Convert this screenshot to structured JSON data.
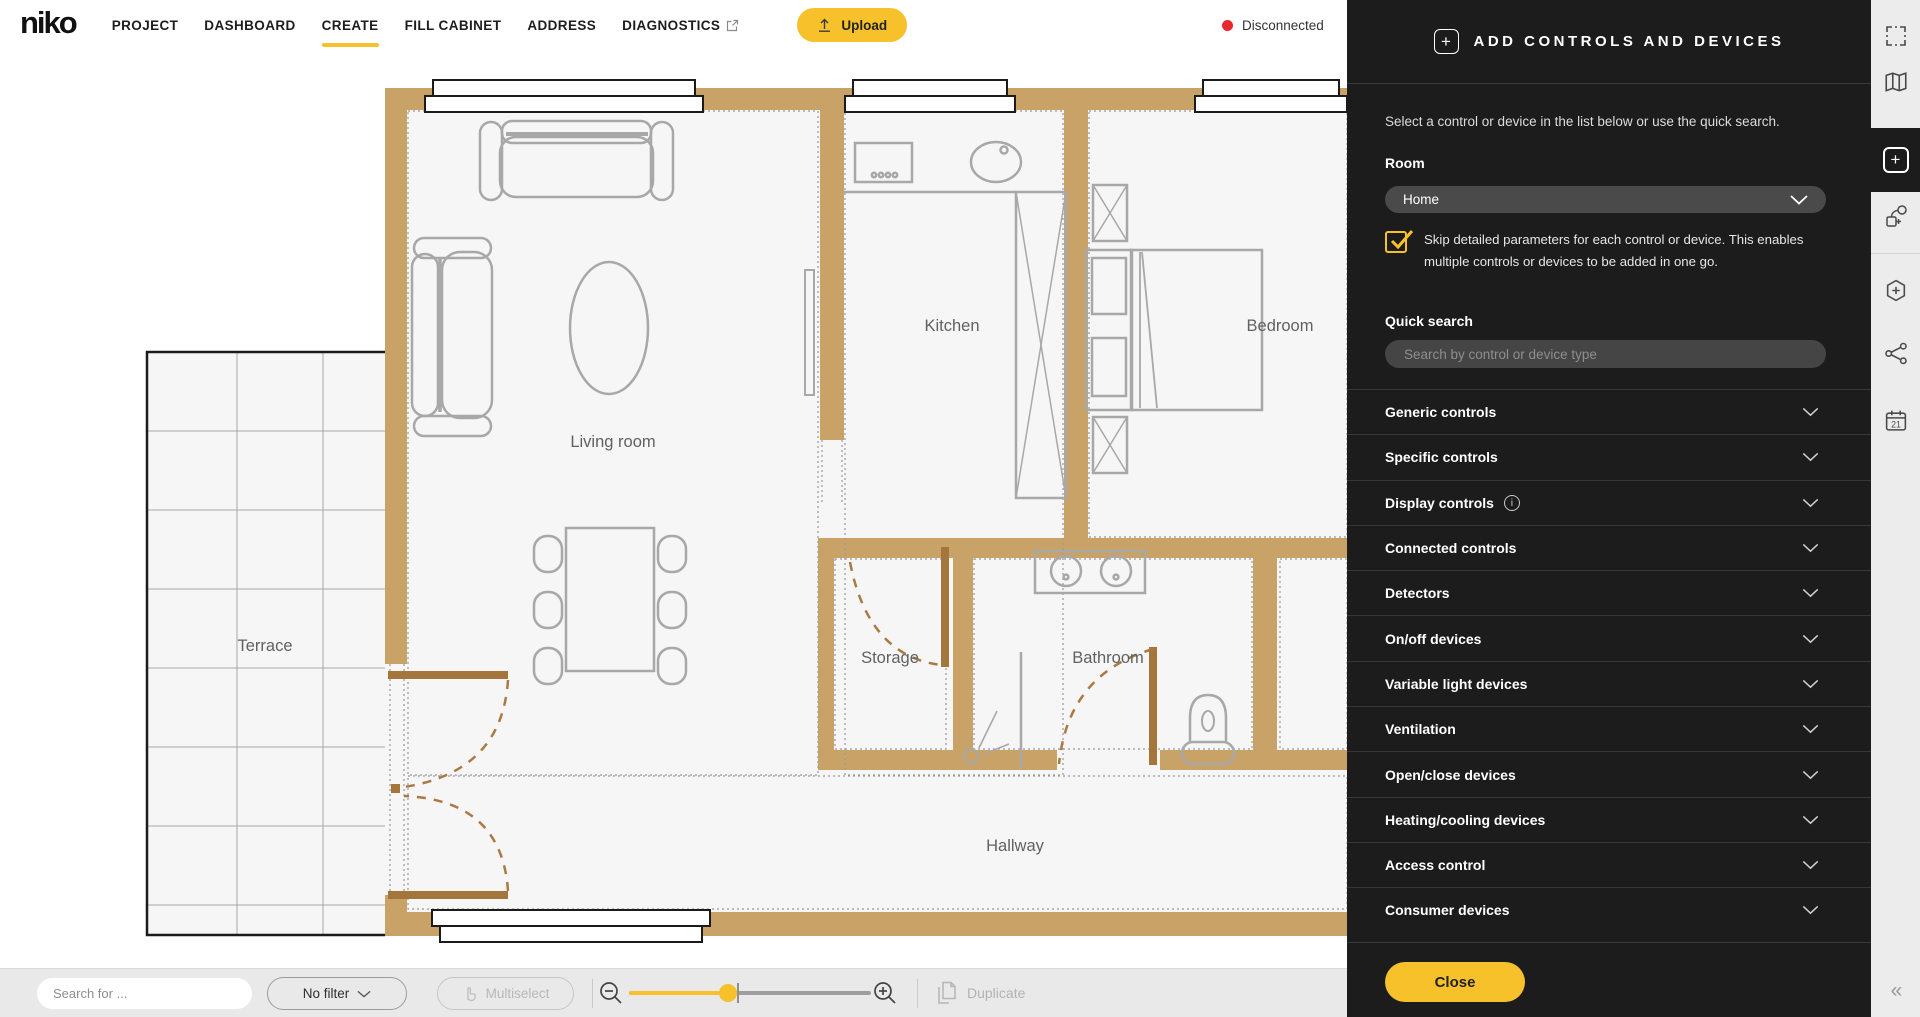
{
  "header": {
    "logo": "niko",
    "nav": [
      {
        "label": "PROJECT"
      },
      {
        "label": "DASHBOARD"
      },
      {
        "label": "CREATE"
      },
      {
        "label": "FILL CABINET"
      },
      {
        "label": "ADDRESS"
      },
      {
        "label": "DIAGNOSTICS",
        "external": true
      }
    ],
    "active": "CREATE",
    "upload": "Upload",
    "status": "Disconnected"
  },
  "panel": {
    "title": "ADD CONTROLS AND DEVICES",
    "intro": "Select a control or device in the list below or use the quick search.",
    "room_label": "Room",
    "room_value": "Home",
    "skip_text": "Skip detailed parameters for each control or device. This enables multiple controls or devices to be added in one go.",
    "quick_search_label": "Quick search",
    "search_placeholder": "Search by control or device type",
    "categories": [
      {
        "label": "Generic controls",
        "info": false
      },
      {
        "label": "Specific controls",
        "info": false
      },
      {
        "label": "Display controls",
        "info": true
      },
      {
        "label": "Connected controls",
        "info": false
      },
      {
        "label": "Detectors",
        "info": false
      },
      {
        "label": "On/off devices",
        "info": false
      },
      {
        "label": "Variable light devices",
        "info": false
      },
      {
        "label": "Ventilation",
        "info": false
      },
      {
        "label": "Open/close devices",
        "info": false
      },
      {
        "label": "Heating/cooling devices",
        "info": false
      },
      {
        "label": "Access control",
        "info": false
      },
      {
        "label": "Consumer devices",
        "info": false
      }
    ],
    "close": "Close"
  },
  "toolbar": {
    "search_placeholder": "Search for ...",
    "filter": "No filter",
    "multiselect": "Multiselect",
    "duplicate": "Duplicate",
    "zoom_fraction": 0.41
  },
  "floorplan": {
    "living": "Living room",
    "kitchen": "Kitchen",
    "bedroom": "Bedroom",
    "terrace": "Terrace",
    "storage": "Storage",
    "bathroom": "Bathroom",
    "hallway": "Hallway"
  },
  "sidebar": {
    "calendar_day": "21",
    "collapse": "«"
  },
  "colors": {
    "accent": "#f6c12b",
    "wall": "#c8a266",
    "status_red": "#e8282d",
    "panel_bg": "#1c1c1c"
  }
}
